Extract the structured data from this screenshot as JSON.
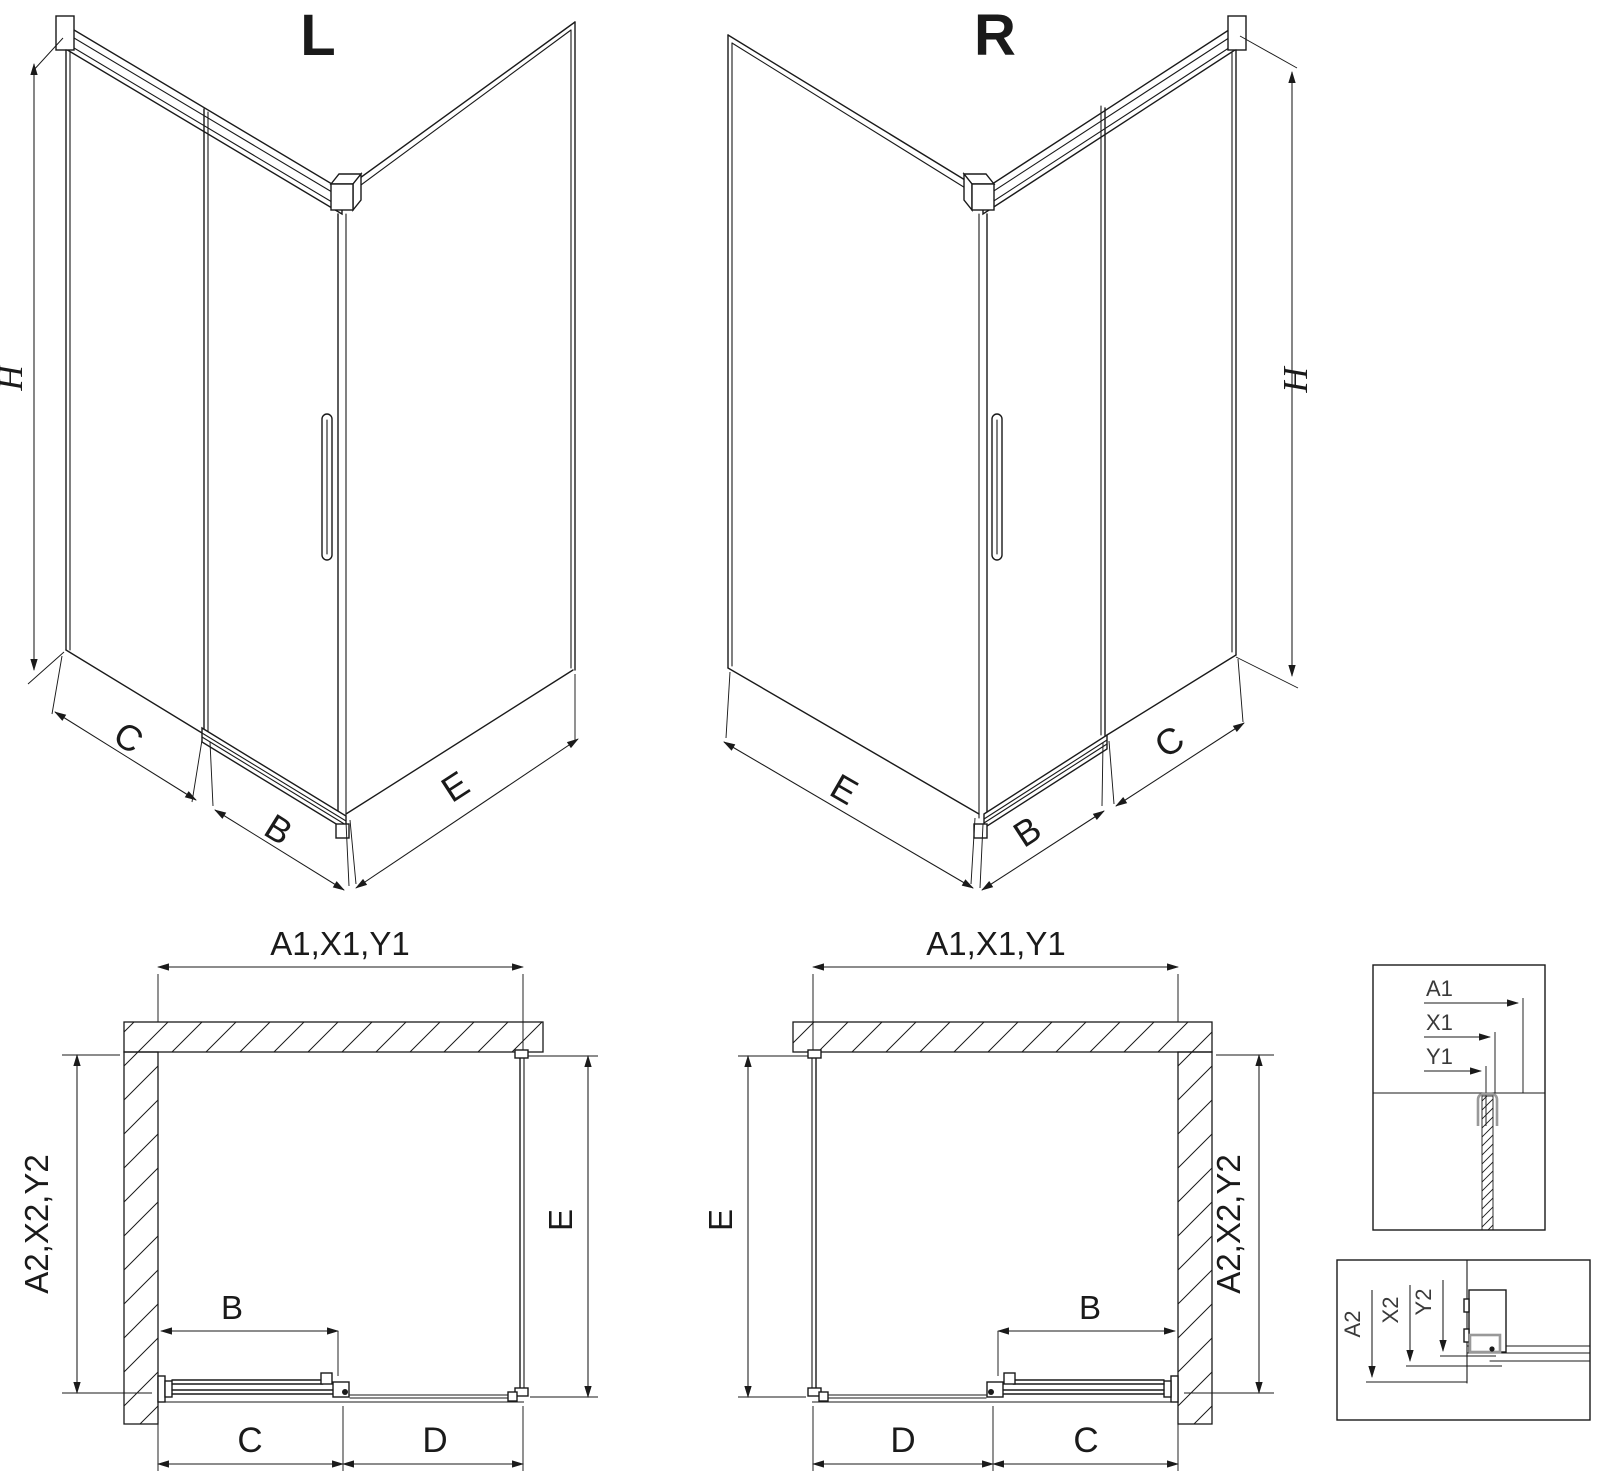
{
  "meta": {
    "background": "#ffffff",
    "line_color": "#1a1a1a",
    "profile_gray_color": "#999999"
  },
  "iso_left": {
    "title": "L",
    "height": "H",
    "fixed_panel": "C",
    "door": "B",
    "side_panel": "E"
  },
  "iso_right": {
    "title": "R",
    "height": "H",
    "fixed_panel": "C",
    "door": "B",
    "side_panel": "E"
  },
  "plan_left": {
    "top": "A1,X1,Y1",
    "depth": "A2,X2,Y2",
    "side": "E",
    "door": "B",
    "near": "C",
    "far": "D"
  },
  "plan_right": {
    "top": "A1,X1,Y1",
    "depth": "A2,X2,Y2",
    "side": "E",
    "door": "B",
    "near": "C",
    "far": "D"
  },
  "detail_top": {
    "a": "A1",
    "x": "X1",
    "y": "Y1"
  },
  "detail_bottom": {
    "a": "A2",
    "x": "X2",
    "y": "Y2"
  }
}
